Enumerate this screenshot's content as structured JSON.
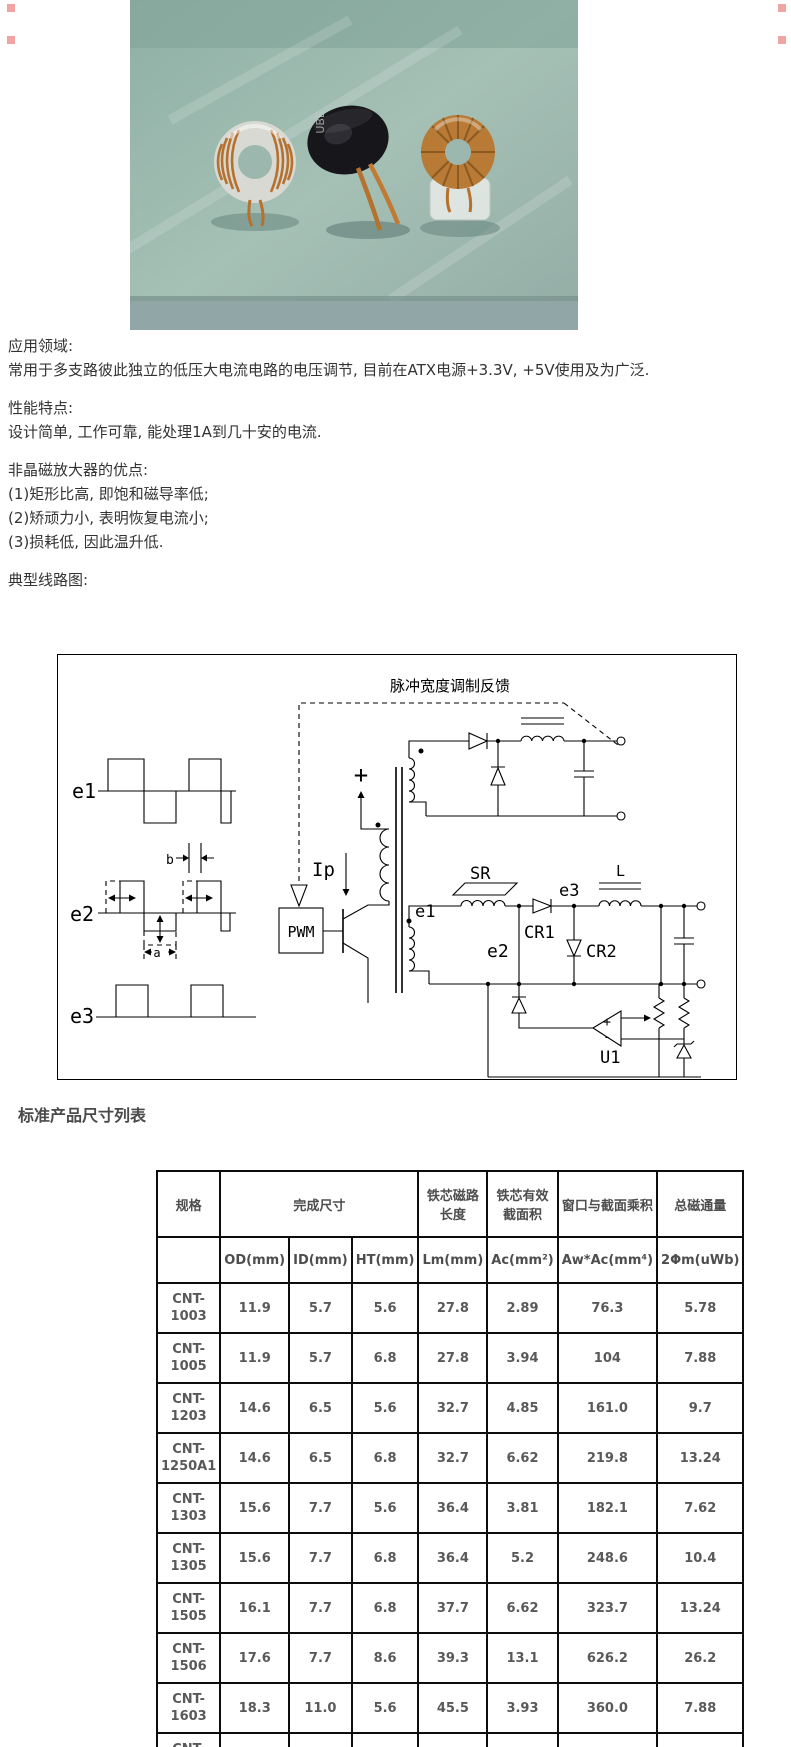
{
  "colors": {
    "corner_mark": "#f0a4a4",
    "body_text": "#333333",
    "heading_text": "#4a4a4a",
    "table_text": "#595959",
    "table_border": "#000000"
  },
  "photo": {
    "sleeve_text": "UBE"
  },
  "intro": {
    "s1_title": "应用领域:",
    "s1_body": "常用于多支路彼此独立的低压大电流电路的电压调节, 目前在ATX电源+3.3V, +5V使用及为广泛.",
    "s2_title": "性能特点:",
    "s2_body": "设计简单, 工作可靠, 能处理1A到几十安的电流.",
    "s3_title": "非晶磁放大器的优点:",
    "s3_items": [
      "(1)矩形比高, 即饱和磁导率低;",
      "(2)矫顽力小, 表明恢复电流小;",
      "(3)损耗低, 因此温升低."
    ],
    "s4_title": "典型线路图:"
  },
  "circuit": {
    "feedback_label": "脉冲宽度调制反馈",
    "pwm_label": "PWM",
    "ip_label": "Ip",
    "supply_plus": "+",
    "wave_e1": "e1",
    "wave_e2": "e2",
    "wave_e3": "e3",
    "dim_a": "a",
    "dim_b": "b",
    "winding_e1": "e1",
    "node_e2": "e2",
    "node_e3": "e3",
    "sr_label": "SR",
    "cr1_label": "CR1",
    "cr2_label": "CR2",
    "l_label": "L",
    "u1_label": "U1",
    "opamp_plus": "+",
    "opamp_minus": "-"
  },
  "table_section": {
    "heading": "标准产品尺寸列表",
    "header_row1": [
      "规格",
      "完成尺寸",
      "铁芯磁路长度",
      "铁芯有效截面积",
      "窗口与截面乘积",
      "总磁通量"
    ],
    "header_row2": [
      "OD(mm)",
      "ID(mm)",
      "HT(mm)",
      "Lm(mm)",
      "Ac(mm²)",
      "Aw*Ac(mm⁴)",
      "2Φm(uWb)"
    ],
    "rows": [
      {
        "name": "CNT-\n1003",
        "values": [
          "11.9",
          "5.7",
          "5.6",
          "27.8",
          "2.89",
          "76.3",
          "5.78"
        ]
      },
      {
        "name": "CNT-\n1005",
        "values": [
          "11.9",
          "5.7",
          "6.8",
          "27.8",
          "3.94",
          "104",
          "7.88"
        ]
      },
      {
        "name": "CNT-\n1203",
        "values": [
          "14.6",
          "6.5",
          "5.6",
          "32.7",
          "4.85",
          "161.0",
          "9.7"
        ]
      },
      {
        "name": "CNT-\n1250A1",
        "values": [
          "14.6",
          "6.5",
          "6.8",
          "32.7",
          "6.62",
          "219.8",
          "13.24"
        ]
      },
      {
        "name": "CNT-\n1303",
        "values": [
          "15.6",
          "7.7",
          "5.6",
          "36.4",
          "3.81",
          "182.1",
          "7.62"
        ]
      },
      {
        "name": "CNT-\n1305",
        "values": [
          "15.6",
          "7.7",
          "6.8",
          "36.4",
          "5.2",
          "248.6",
          "10.4"
        ]
      },
      {
        "name": "CNT-\n1505",
        "values": [
          "16.1",
          "7.7",
          "6.8",
          "37.7",
          "6.62",
          "323.7",
          "13.24"
        ]
      },
      {
        "name": "CNT-\n1506",
        "values": [
          "17.6",
          "7.7",
          "8.6",
          "39.3",
          "13.1",
          "626.2",
          "26.2"
        ]
      },
      {
        "name": "CNT-\n1603",
        "values": [
          "18.3",
          "11.0",
          "5.6",
          "45.5",
          "3.93",
          "360.0",
          "7.88"
        ]
      },
      {
        "name": "CNT-\n1805",
        "values": [
          "20.6",
          "10.1",
          "6.9",
          "48.0",
          "9.77",
          "829.5",
          "19.5"
        ]
      }
    ]
  }
}
